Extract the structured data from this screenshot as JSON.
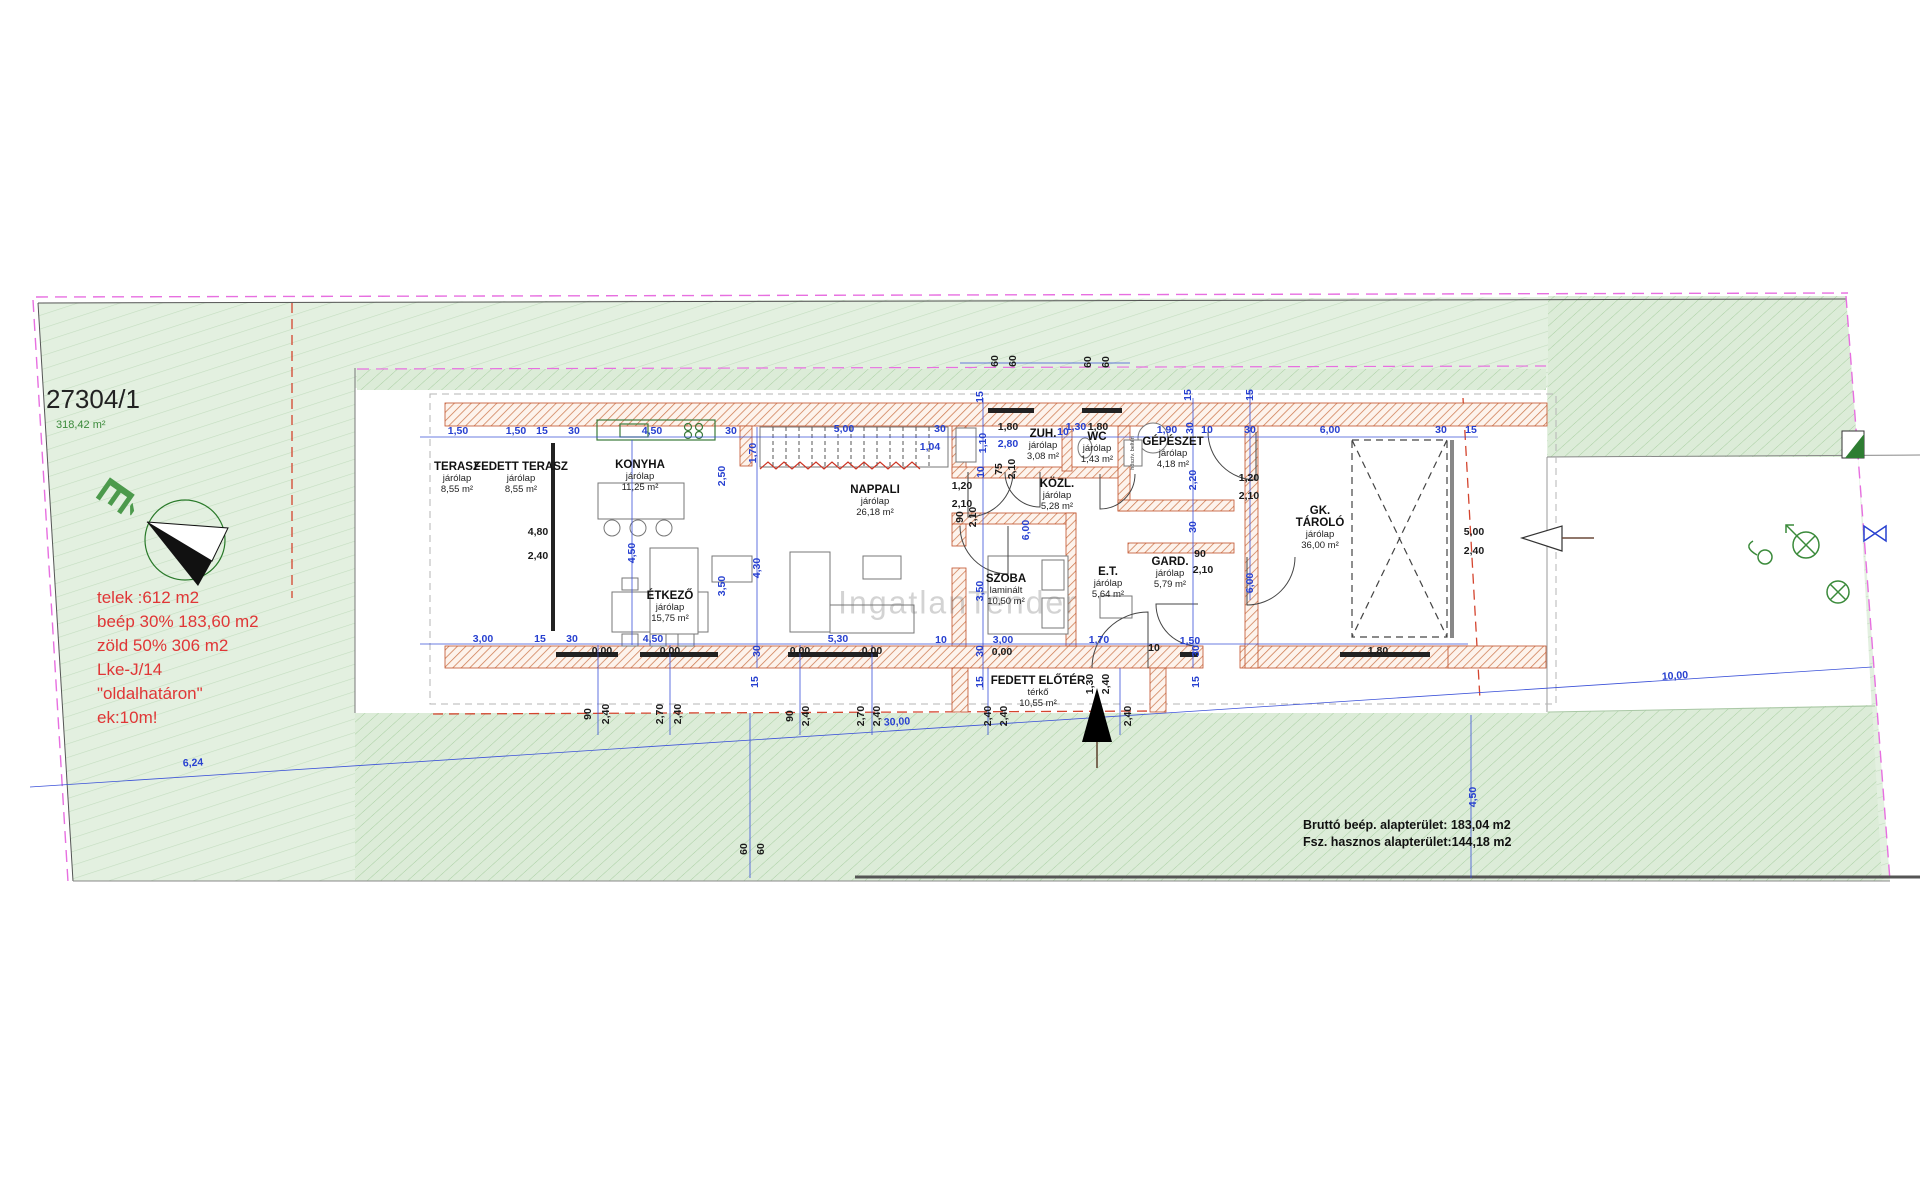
{
  "meta": {
    "parcel_number": "27304/1",
    "parcel_area": "318,42 m²",
    "north_letter": "É",
    "watermark": "IngatlanTender",
    "equipment_label": "hőszív. beltéri"
  },
  "regulations": {
    "lines": [
      "telek :612 m2",
      "beép 30% 183,60 m2",
      "zöld 50% 306 m2",
      "Lke-J/14",
      "\"oldalhatáron\"",
      "ek:10m!"
    ]
  },
  "summary": {
    "line1": "Bruttó beép. alapterület: 183,04 m2",
    "line2": "Fsz. hasznos alapterület:144,18 m2"
  },
  "rooms": [
    {
      "name": "TERASZ",
      "floor": "járólap",
      "area": "8,55 m²",
      "x": 457,
      "y": 461
    },
    {
      "name": "FEDETT TERASZ",
      "floor": "járólap",
      "area": "8,55 m²",
      "x": 521,
      "y": 461
    },
    {
      "name": "KONYHA",
      "floor": "járólap",
      "area": "11,25 m²",
      "x": 640,
      "y": 459
    },
    {
      "name": "ÉTKEZŐ",
      "floor": "járólap",
      "area": "15,75 m²",
      "x": 670,
      "y": 590
    },
    {
      "name": "NAPPALI",
      "floor": "járólap",
      "area": "26,18 m²",
      "x": 875,
      "y": 484
    },
    {
      "name": "ZUH.",
      "floor": "járólap",
      "area": "3,08 m²",
      "x": 1043,
      "y": 428
    },
    {
      "name": "WC",
      "floor": "járólap",
      "area": "1,43 m²",
      "x": 1097,
      "y": 431
    },
    {
      "name": "KÖZL.",
      "floor": "járólap",
      "area": "5,28 m²",
      "x": 1057,
      "y": 478
    },
    {
      "name": "GÉPÉSZET",
      "floor": "járólap",
      "area": "4,18 m²",
      "x": 1173,
      "y": 436
    },
    {
      "name": "SZOBA",
      "floor": "laminált",
      "area": "10,50 m²",
      "x": 1006,
      "y": 573
    },
    {
      "name": "E.T.",
      "floor": "járólap",
      "area": "5,64 m²",
      "x": 1108,
      "y": 566
    },
    {
      "name": "GARD.",
      "floor": "járólap",
      "area": "5,79 m²",
      "x": 1170,
      "y": 556
    },
    {
      "name": "GK.|TÁROLÓ",
      "floor": "járólap",
      "area": "36,00 m²",
      "x": 1320,
      "y": 505
    },
    {
      "name": "FEDETT ELŐTÉR",
      "floor": "térkő",
      "area": "10,55 m²",
      "x": 1038,
      "y": 675
    }
  ],
  "dimensions": [
    [
      "1,50",
      458,
      431,
      0,
      "b"
    ],
    [
      "1,50",
      516,
      431,
      0,
      "b"
    ],
    [
      "15",
      542,
      431,
      0,
      "b"
    ],
    [
      "30",
      574,
      431,
      0,
      "b"
    ],
    [
      "4,50",
      652,
      431,
      0,
      "b"
    ],
    [
      "30",
      731,
      431,
      0,
      "b"
    ],
    [
      "5,00",
      844,
      429,
      0,
      "b"
    ],
    [
      "30",
      940,
      429,
      0,
      "b"
    ],
    [
      "1,80",
      1008,
      427,
      0,
      "k"
    ],
    [
      "2,80",
      1008,
      444,
      0,
      "b"
    ],
    [
      "10",
      1063,
      432,
      0,
      "b"
    ],
    [
      "1,30",
      1076,
      427,
      0,
      "b"
    ],
    [
      "1,80",
      1098,
      427,
      0,
      "k"
    ],
    [
      "1,90",
      1167,
      430,
      0,
      "b"
    ],
    [
      "30",
      1190,
      428,
      -90,
      "b"
    ],
    [
      "10",
      1207,
      430,
      0,
      "b"
    ],
    [
      "30",
      1250,
      430,
      0,
      "b"
    ],
    [
      "6,00",
      1330,
      430,
      0,
      "b"
    ],
    [
      "30",
      1441,
      430,
      0,
      "b"
    ],
    [
      "15",
      1471,
      430,
      0,
      "b"
    ],
    [
      "1,04",
      930,
      447,
      0,
      "b"
    ],
    [
      "15",
      980,
      397,
      -90,
      "b"
    ],
    [
      "15",
      1188,
      395,
      -90,
      "b"
    ],
    [
      "15",
      1250,
      395,
      -90,
      "b"
    ],
    [
      "60",
      995,
      361,
      -90,
      "k"
    ],
    [
      "60",
      1013,
      361,
      -90,
      "k"
    ],
    [
      "60",
      1088,
      362,
      -90,
      "k"
    ],
    [
      "60",
      1106,
      362,
      -90,
      "k"
    ],
    [
      "60",
      744,
      849,
      -90,
      "k"
    ],
    [
      "60",
      761,
      849,
      -90,
      "k"
    ],
    [
      "2,50",
      722,
      476,
      -90,
      "b"
    ],
    [
      "1,70",
      753,
      453,
      -90,
      "b"
    ],
    [
      "4,50",
      632,
      553,
      -90,
      "b"
    ],
    [
      "4,30",
      757,
      568,
      -90,
      "b"
    ],
    [
      "3,50",
      722,
      586,
      -90,
      "b"
    ],
    [
      "1,10",
      983,
      443,
      -90,
      "b"
    ],
    [
      "10",
      981,
      472,
      -90,
      "b"
    ],
    [
      "2,20",
      1193,
      480,
      -90,
      "b"
    ],
    [
      "30",
      1193,
      527,
      -90,
      "b"
    ],
    [
      "6,00",
      1250,
      583,
      -90,
      "b"
    ],
    [
      "6,00",
      1026,
      530,
      -90,
      "b"
    ],
    [
      "3,50",
      980,
      591,
      -90,
      "b"
    ],
    [
      "30",
      980,
      651,
      -90,
      "b"
    ],
    [
      "15",
      980,
      682,
      -90,
      "b"
    ],
    [
      "30",
      757,
      651,
      -90,
      "b"
    ],
    [
      "15",
      755,
      682,
      -90,
      "b"
    ],
    [
      "30",
      1196,
      651,
      -90,
      "b"
    ],
    [
      "15",
      1196,
      682,
      -90,
      "b"
    ],
    [
      "4,80",
      538,
      532,
      0,
      "k"
    ],
    [
      "2,40",
      538,
      556,
      0,
      "k"
    ],
    [
      "1,20",
      962,
      486,
      0,
      "k"
    ],
    [
      "2,10",
      962,
      504,
      0,
      "k"
    ],
    [
      "1,20",
      1249,
      478,
      0,
      "k"
    ],
    [
      "2,10",
      1249,
      496,
      0,
      "k"
    ],
    [
      "90",
      1200,
      554,
      0,
      "k"
    ],
    [
      "2,10",
      1203,
      570,
      0,
      "k"
    ],
    [
      "90",
      960,
      517,
      -90,
      "k"
    ],
    [
      "2,10",
      973,
      517,
      -90,
      "k"
    ],
    [
      "75",
      999,
      469,
      -90,
      "k"
    ],
    [
      "2,10",
      1012,
      469,
      -90,
      "k"
    ],
    [
      "5,00",
      1474,
      532,
      0,
      "k"
    ],
    [
      "2,40",
      1474,
      551,
      0,
      "k"
    ],
    [
      "1,80",
      1378,
      651,
      0,
      "k"
    ],
    [
      "3,00",
      483,
      639,
      0,
      "b"
    ],
    [
      "15",
      540,
      639,
      0,
      "b"
    ],
    [
      "30",
      572,
      639,
      0,
      "b"
    ],
    [
      "4,50",
      653,
      639,
      0,
      "b"
    ],
    [
      "5,30",
      838,
      639,
      0,
      "b"
    ],
    [
      "10",
      941,
      640,
      0,
      "b"
    ],
    [
      "3,00",
      1003,
      640,
      0,
      "b"
    ],
    [
      "1,70",
      1099,
      640,
      0,
      "b"
    ],
    [
      "1,50",
      1190,
      641,
      0,
      "b"
    ],
    [
      "10",
      1154,
      648,
      0,
      "k"
    ],
    [
      "0,00",
      602,
      651,
      0,
      "k"
    ],
    [
      "0,00",
      670,
      651,
      0,
      "k"
    ],
    [
      "0,00",
      800,
      651,
      0,
      "k"
    ],
    [
      "0,00",
      872,
      651,
      0,
      "k"
    ],
    [
      "0,00",
      1002,
      652,
      0,
      "k"
    ],
    [
      "90",
      588,
      714,
      -90,
      "k"
    ],
    [
      "2,40",
      606,
      714,
      -90,
      "k"
    ],
    [
      "2,70",
      660,
      714,
      -90,
      "k"
    ],
    [
      "2,40",
      678,
      714,
      -90,
      "k"
    ],
    [
      "90",
      790,
      716,
      -90,
      "k"
    ],
    [
      "2,40",
      806,
      716,
      -90,
      "k"
    ],
    [
      "2,70",
      861,
      716,
      -90,
      "k"
    ],
    [
      "2,40",
      877,
      716,
      -90,
      "k"
    ],
    [
      "2,40",
      988,
      716,
      -90,
      "k"
    ],
    [
      "2,40",
      1004,
      716,
      -90,
      "k"
    ],
    [
      "1,30",
      1090,
      684,
      -90,
      "k"
    ],
    [
      "2,40",
      1106,
      684,
      -90,
      "k"
    ],
    [
      "2,40",
      1128,
      716,
      -90,
      "k"
    ],
    [
      "6,24",
      193,
      763,
      -3,
      "b"
    ],
    [
      "30,00",
      897,
      722,
      -3,
      "b"
    ],
    [
      "10,00",
      1675,
      676,
      -4,
      "b"
    ],
    [
      "4,50",
      1473,
      797,
      -90,
      "b"
    ]
  ],
  "colors": {
    "dim_blue": "#2740d0",
    "dim_black": "#1a1a1a",
    "regulation_red": "#e03636",
    "parcel_green": "#e3f0e0",
    "wall_hatch": "#c4683f",
    "boundary_magenta": "#e76fe0",
    "north_green": "#4c9a4c"
  }
}
